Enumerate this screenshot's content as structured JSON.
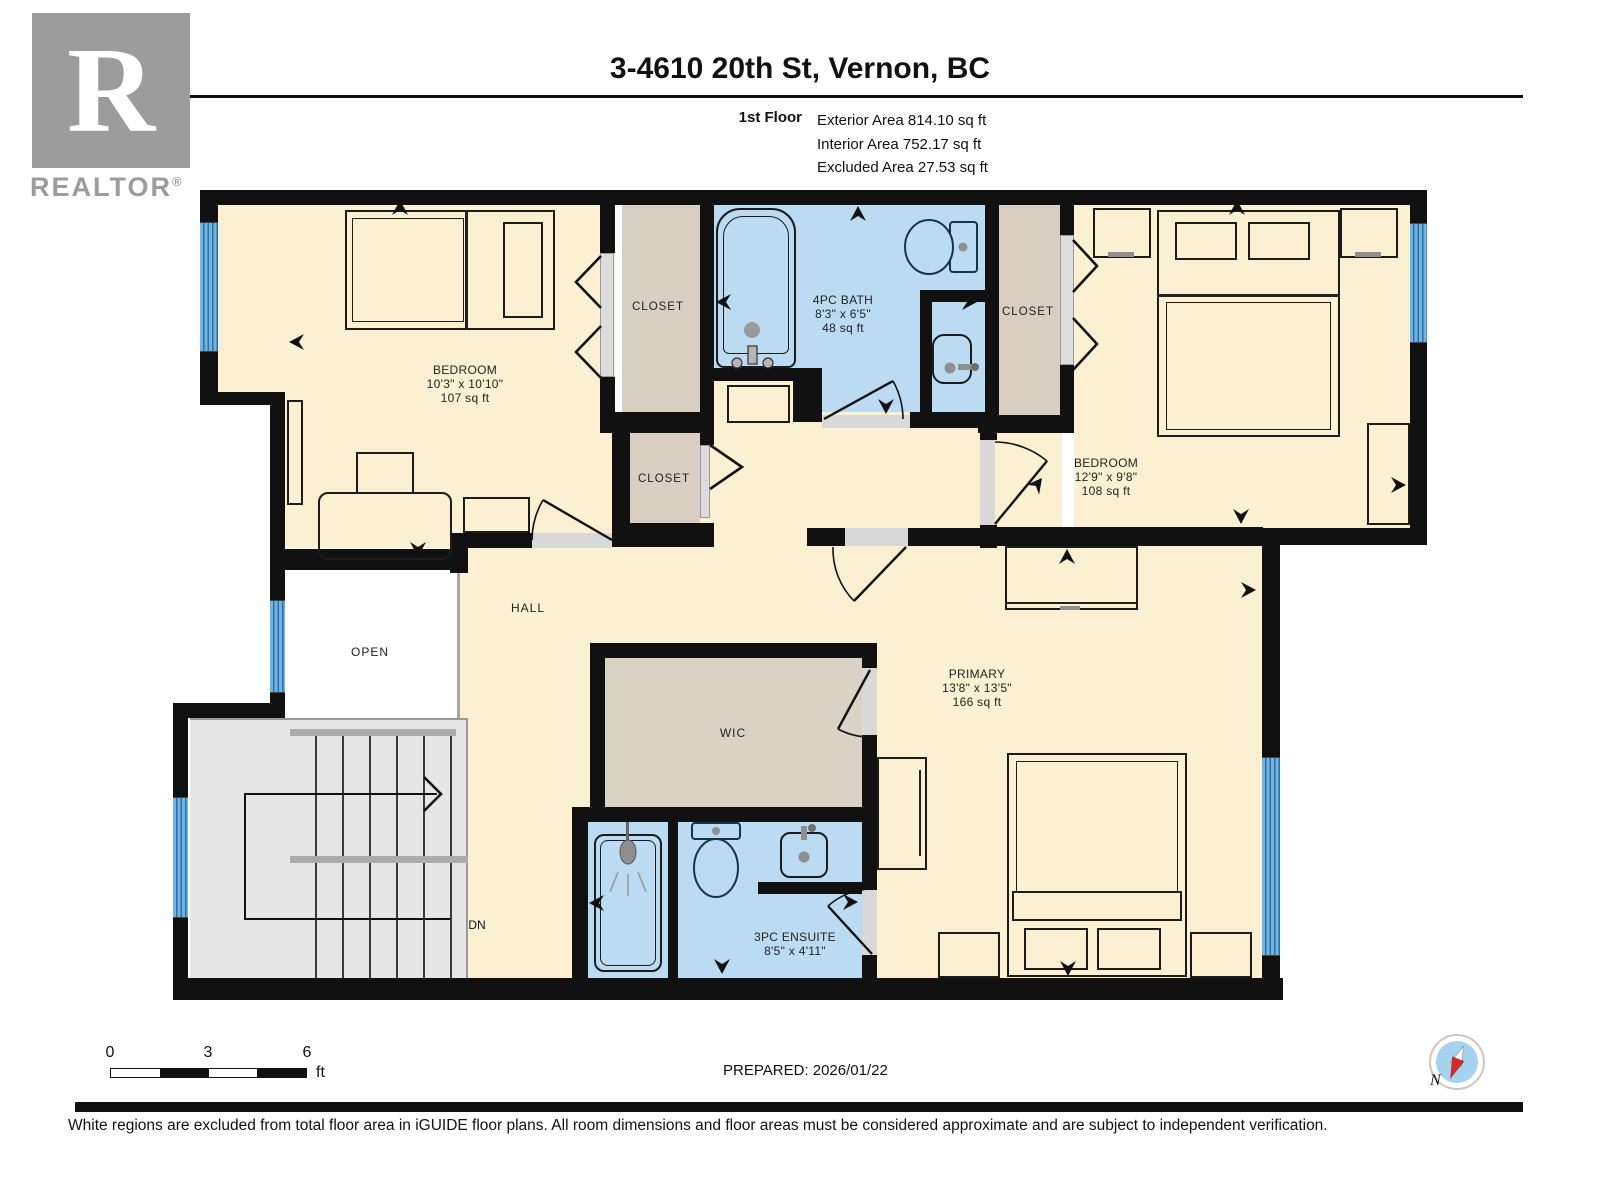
{
  "header": {
    "title": "3-4610 20th St, Vernon, BC",
    "floor_label": "1st Floor",
    "exterior_area": "Exterior Area 814.10 sq ft",
    "interior_area": "Interior Area 752.17 sq ft",
    "excluded_area": "Excluded Area 27.53 sq ft"
  },
  "logo": {
    "letter": "R",
    "text": "REALTOR",
    "registered": "®"
  },
  "rooms": {
    "bedroom1": {
      "name": "BEDROOM",
      "dims": "10'3\" x 10'10\"",
      "area": "107 sq ft"
    },
    "bath": {
      "name": "4PC BATH",
      "dims": "8'3\" x 6'5\"",
      "area": "48 sq ft"
    },
    "bedroom2": {
      "name": "BEDROOM",
      "dims": "12'9\" x 9'8\"",
      "area": "108 sq ft"
    },
    "primary": {
      "name": "PRIMARY",
      "dims": "13'8\" x 13'5\"",
      "area": "166 sq ft"
    },
    "ensuite": {
      "name": "3PC ENSUITE",
      "dims": "8'5\" x 4'11\""
    },
    "closet": "CLOSET",
    "hall": "HALL",
    "open": "OPEN",
    "wic": "WIC",
    "stairs_down": "DN"
  },
  "scale_bar": {
    "t0": "0",
    "t3": "3",
    "t6": "6",
    "unit": "ft"
  },
  "prepared": "PREPARED: 2026/01/22",
  "compass": {
    "north": "N"
  },
  "footer": "White regions are excluded from total floor area in iGUIDE floor plans. All room dimensions and floor areas must be considered approximate and are subject to independent verification.",
  "colors": {
    "floor": "#FBF0D1",
    "bath": "#BBDBF2",
    "closet": "#D8CEC2",
    "stairs": "#E6E6E6",
    "window": "#5FA8D8",
    "wall": "#111111"
  }
}
